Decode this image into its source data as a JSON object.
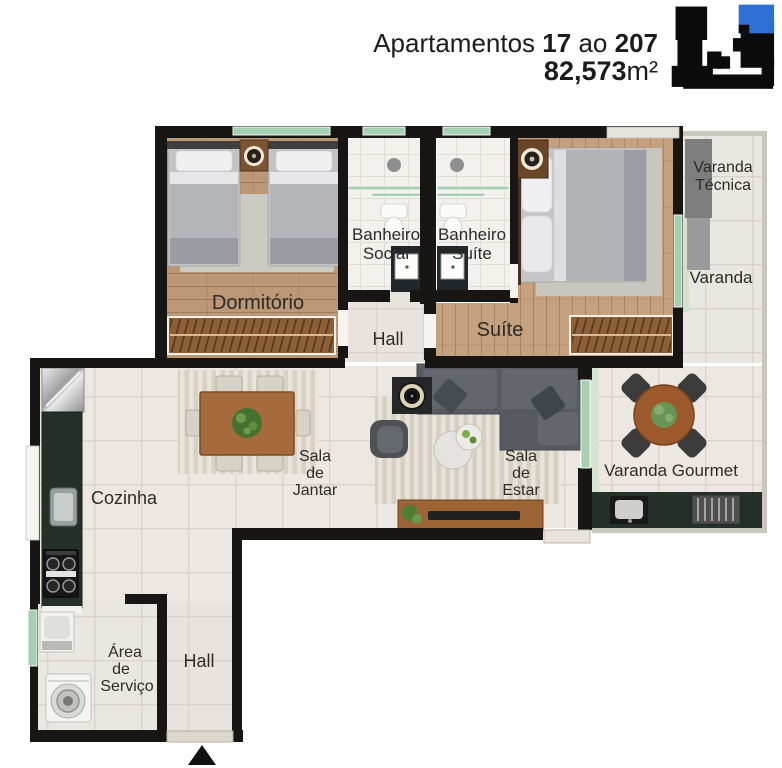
{
  "header": {
    "title": {
      "word1": "Apartamentos",
      "num1": "17",
      "word2": "ao",
      "num2": "207"
    },
    "area": {
      "value": "82,573",
      "unit": "m²"
    }
  },
  "keyplan": {
    "base_color": "#0b0b0b",
    "highlight_color": "#2e6fd6"
  },
  "rooms": {
    "dormitorio": {
      "label": "Dormitório"
    },
    "banheiro_social": {
      "line1": "Banheiro",
      "line2": "Social"
    },
    "banheiro_suite": {
      "line1": "Banheiro",
      "line2": "Suíte"
    },
    "hall_upper": {
      "label": "Hall"
    },
    "suite": {
      "label": "Suíte"
    },
    "varanda_tecnica": {
      "line1": "Varanda",
      "line2": "Técnica"
    },
    "varanda": {
      "label": "Varanda"
    },
    "sala_de_jantar": {
      "line1": "Sala",
      "line2": "de",
      "line3": "Jantar"
    },
    "sala_de_estar": {
      "line1": "Sala",
      "line2": "de",
      "line3": "Estar"
    },
    "varanda_gourmet": {
      "label": "Varanda Gourmet"
    },
    "cozinha": {
      "label": "Cozinha"
    },
    "area_de_servico": {
      "line1": "Área",
      "line2": "de",
      "line3": "Serviço"
    },
    "hall_entrada": {
      "label": "Hall"
    }
  },
  "colors": {
    "wall": "#171614",
    "label": "#2d2b28",
    "accent_blue": "#2e6fd6",
    "glass_green": "#a7d0b2",
    "wood_dorm": "#bd9877",
    "wood_suite": "#c5a17f",
    "tile_light": "#ece8e1",
    "tile_bath": "#f3f1ed",
    "counter_dark": "#233028",
    "furniture_brown": "#9c6434",
    "sofa_gray": "#575b61"
  }
}
